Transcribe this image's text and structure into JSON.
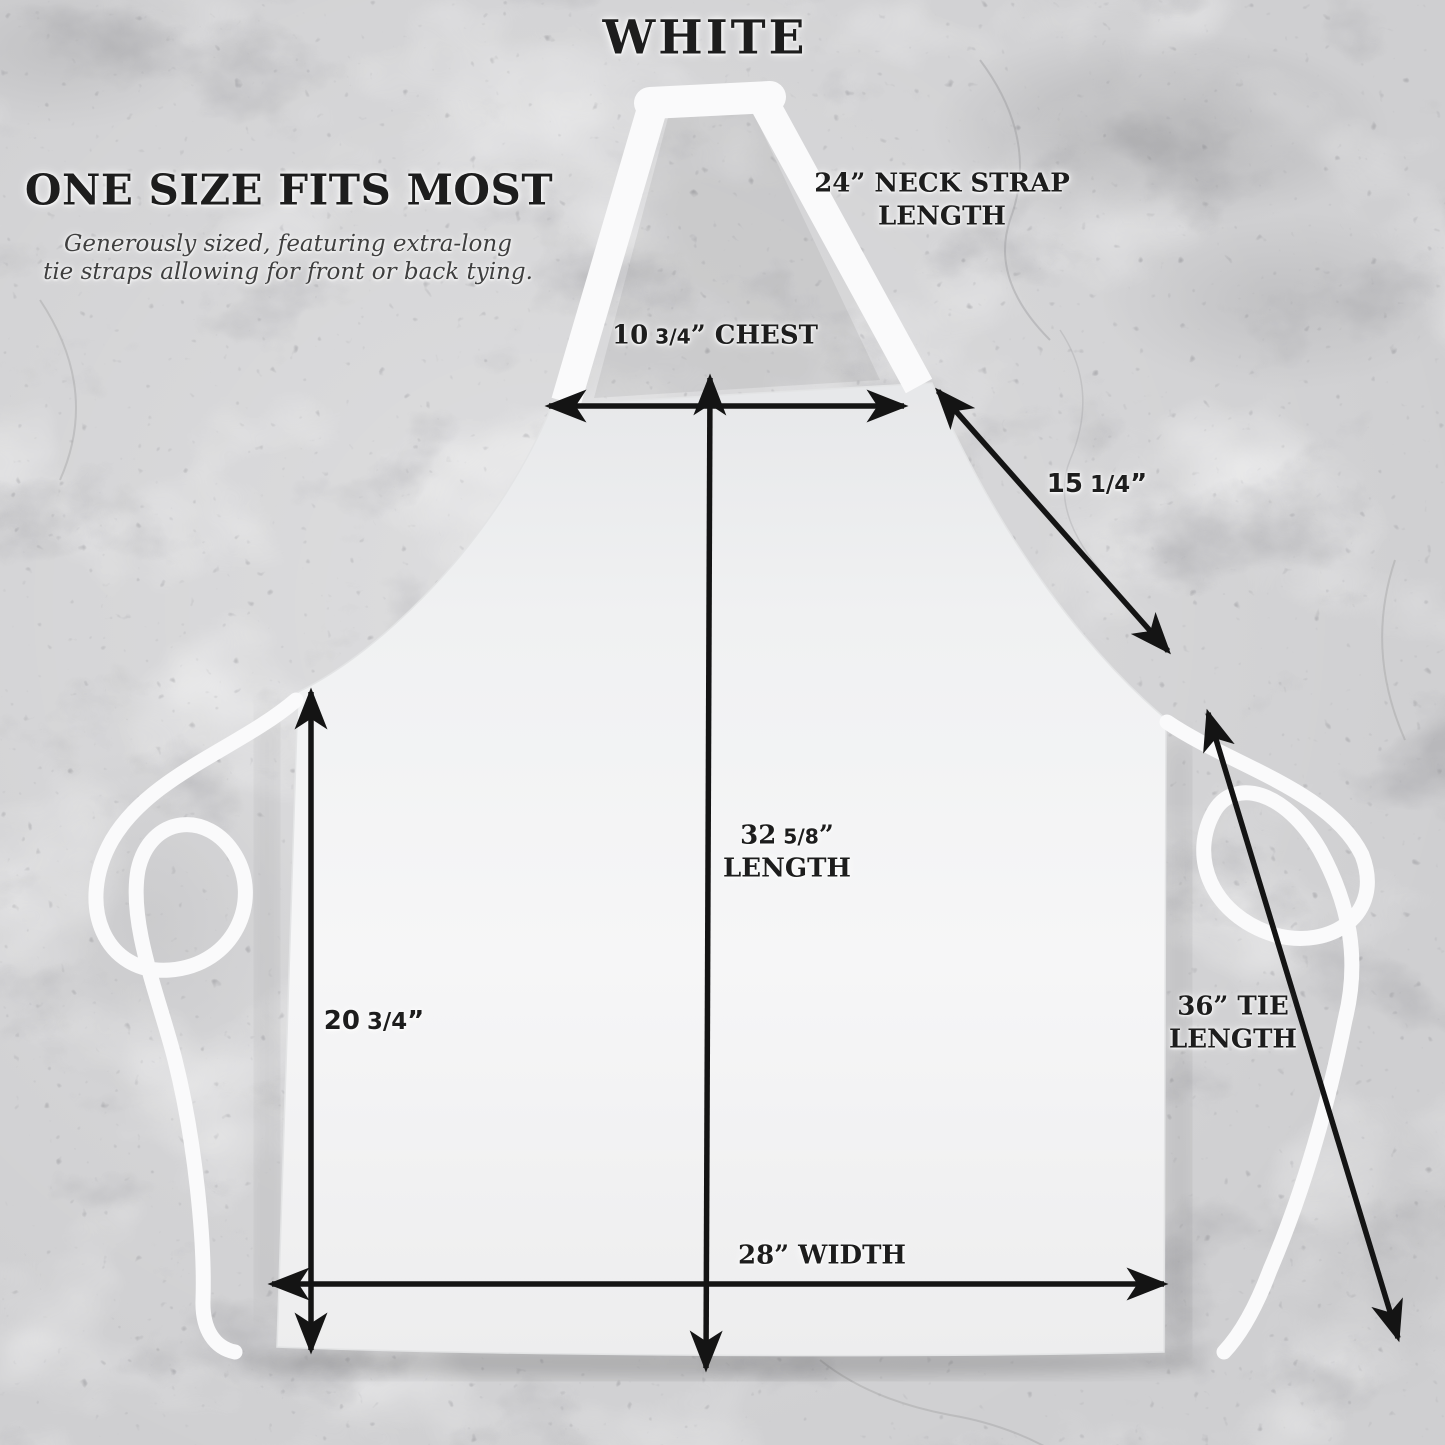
{
  "title": "WHITE",
  "intro": {
    "heading": "ONE SIZE FITS MOST",
    "subline1": "Generously sized, featuring extra-long",
    "subline2": "tie straps allowing for front or back tying."
  },
  "measurements": {
    "neck_strap": {
      "line1": "24” NECK STRAP",
      "line2": "LENGTH"
    },
    "chest": {
      "number": "10",
      "fraction": "3/4",
      "suffix": "” CHEST"
    },
    "bib_diagonal": {
      "number": "15",
      "fraction": "1/4",
      "suffix": "”"
    },
    "length": {
      "number": "32",
      "fraction": "5/8",
      "suffix": "”",
      "line2": "LENGTH"
    },
    "side": {
      "number": "20",
      "fraction": "3/4",
      "suffix": "”"
    },
    "tie": {
      "line1": "36” TIE",
      "line2": "LENGTH"
    },
    "width": {
      "text": "28” WIDTH"
    }
  },
  "colors": {
    "marble_base": "#cfcfd1",
    "apron_white": "#f4f4f5",
    "strap_white": "#fafafb",
    "arrow_black": "#141414",
    "text_dark": "#1d1d1d",
    "text_muted": "#3f3f3f"
  }
}
